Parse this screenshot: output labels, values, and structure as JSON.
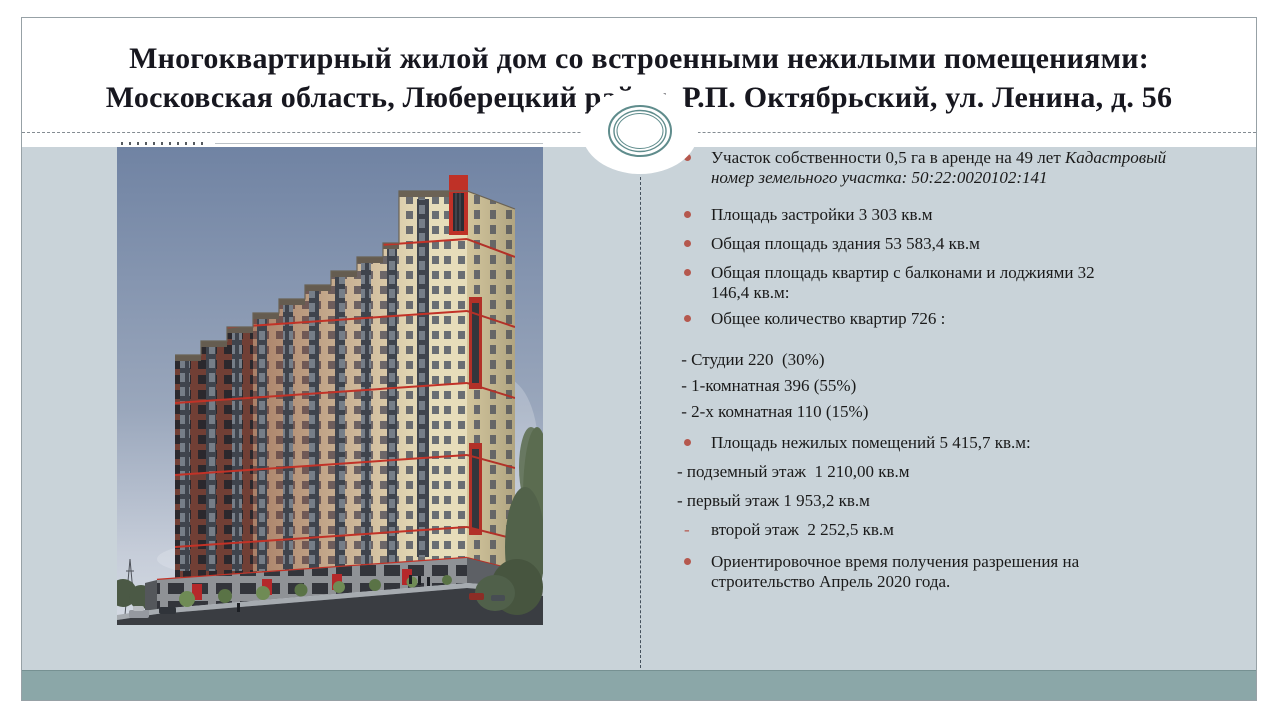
{
  "slide": {
    "title_line1": "Многоквартирный жилой дом со встроенными нежилыми помещениями:",
    "title_line2": "Московская область, Люберецкий район, Р.П. Октябрьский, ул. Ленина, д. 56"
  },
  "facts": [
    {
      "marker": "dot",
      "text": "Участок собственности 0,5 га в аренде на 49 лет ",
      "italic": "Кадастровый\nномер земельного участка: 50:22:0020102:141"
    },
    {
      "marker": "dot",
      "text": "Площадь застройки 3 303 кв.м",
      "italic": ""
    },
    {
      "marker": "dot",
      "text": "Общая площадь здания 53 583,4 кв.м",
      "italic": ""
    },
    {
      "marker": "dot",
      "text": "Общая площадь квартир с балконами и лоджиями 32\n146,4 кв.м:",
      "italic": ""
    },
    {
      "marker": "dot",
      "text": "Общее количество квартир 726 :",
      "italic": ""
    },
    {
      "marker": "none",
      "text": " - Студии 220  (30%)",
      "italic": ""
    },
    {
      "marker": "none",
      "text": " - 1-комнатная 396 (55%)",
      "italic": ""
    },
    {
      "marker": "none",
      "text": " - 2-х комнатная 110 (15%)",
      "italic": ""
    },
    {
      "marker": "dot",
      "text": "Площадь нежилых помещений 5 415,7 кв.м:",
      "italic": ""
    },
    {
      "marker": "none",
      "text": "- подземный этаж  1 210,00 кв.м",
      "italic": ""
    },
    {
      "marker": "none",
      "text": "- первый этаж 1 953,2 кв.м",
      "italic": ""
    },
    {
      "marker": "dash",
      "text": "второй этаж  2 252,5 кв.м",
      "italic": ""
    },
    {
      "marker": "dot",
      "text": "Ориентировочное время получения разрешения на\nстроительство Апрель 2020 года.",
      "italic": ""
    }
  ],
  "building_image": {
    "name": "building-rendering"
  },
  "colors": {
    "accent": "#b5584e",
    "content_bg": "#c9d3d9",
    "band": "#8ba7a8",
    "frame_line": "#97a1a6",
    "dashed_line": "#848c92",
    "divider_line": "#44505c",
    "title_text": "#17171f",
    "body_text": "#1a1a1a",
    "ornament_ring": "#5f8c8c"
  }
}
